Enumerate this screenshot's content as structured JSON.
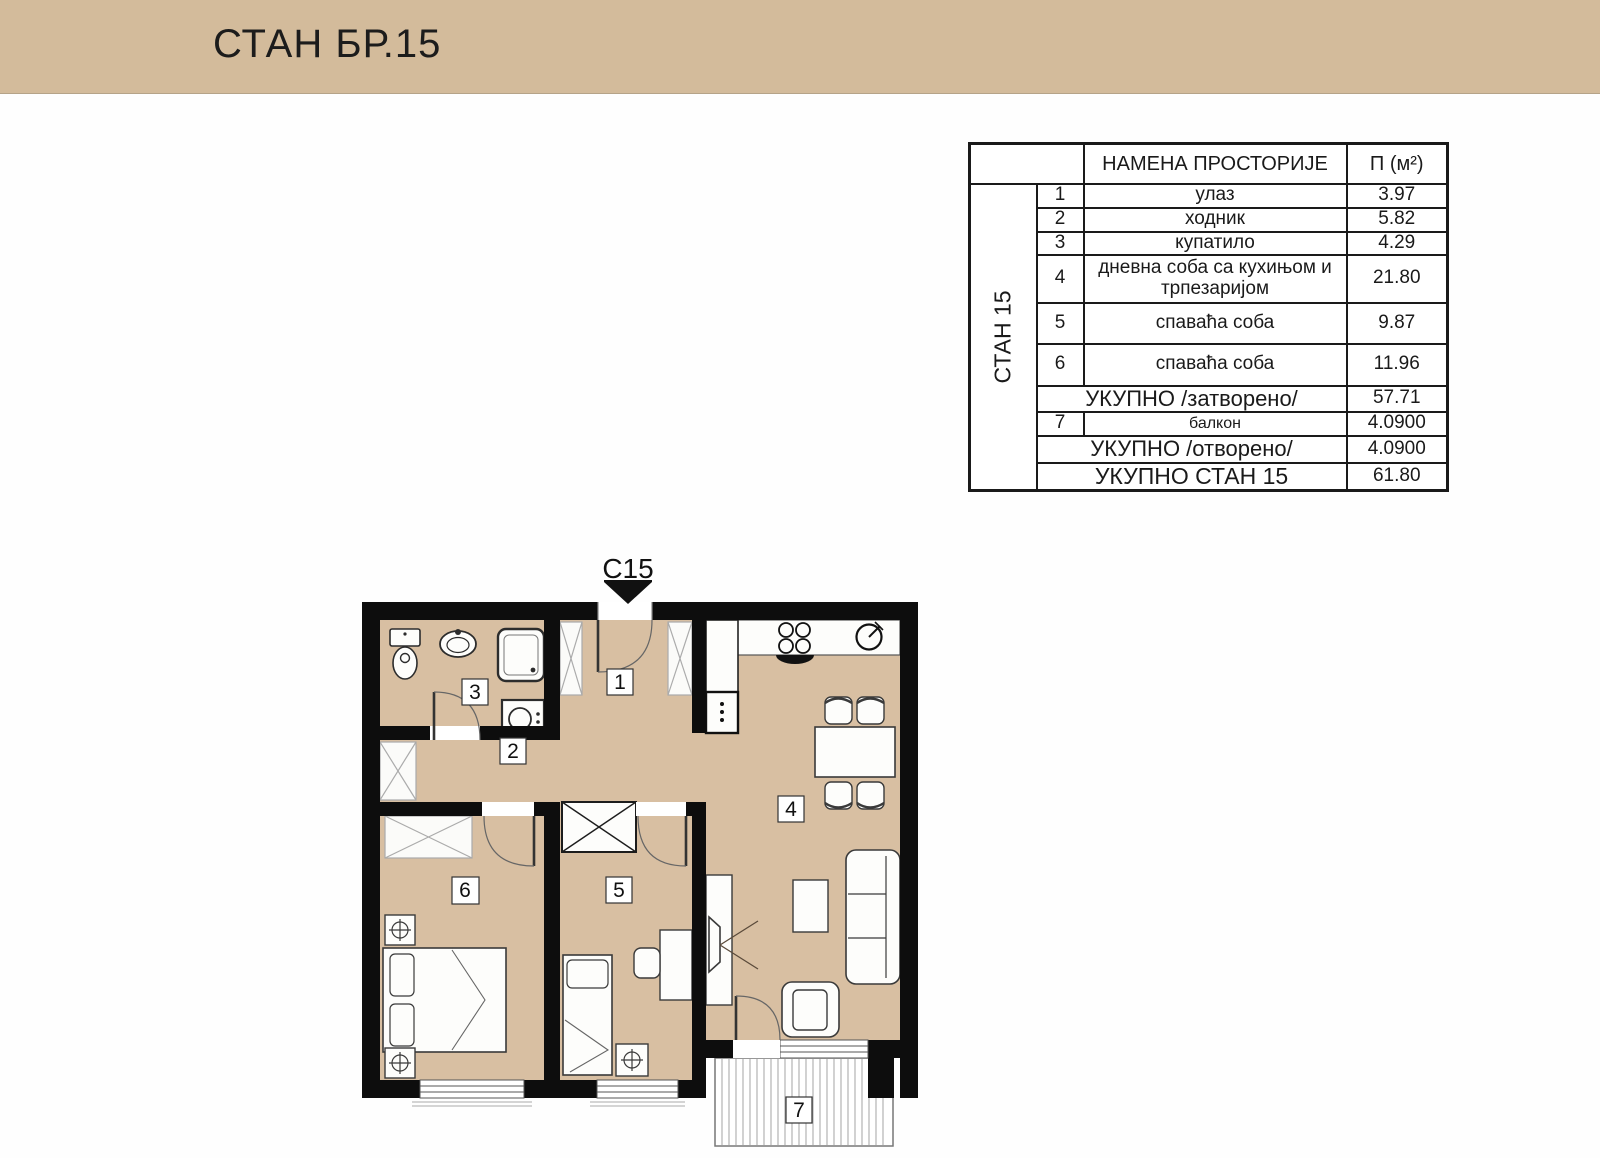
{
  "header": {
    "title": "СТАН БР.15",
    "bg_color": "#d3bb9b"
  },
  "table": {
    "group_label": "СТАН 15",
    "headers": {
      "name": "НАМЕНА ПРОСТОРИЈЕ",
      "area": "П (м²)"
    },
    "rows": [
      {
        "num": "1",
        "name": "улаз",
        "area": "3.97"
      },
      {
        "num": "2",
        "name": "ходник",
        "area": "5.82"
      },
      {
        "num": "3",
        "name": "купатило",
        "area": "4.29"
      },
      {
        "num": "4",
        "name": "дневна соба са кухињом и трпезаријом",
        "area": "21.80"
      },
      {
        "num": "5",
        "name": "спаваћа соба",
        "area": "9.87"
      },
      {
        "num": "6",
        "name": "спаваћа соба",
        "area": "11.96"
      }
    ],
    "subtotal_closed": {
      "label": "УКУПНО /затворено/",
      "area": "57.71"
    },
    "balcony": {
      "num": "7",
      "name": "балкон",
      "area": "4.0900"
    },
    "subtotal_open": {
      "label": "УКУПНО /отворено/",
      "area": "4.0900"
    },
    "total": {
      "label": "УКУПНО СТАН 15",
      "area": "61.80"
    }
  },
  "plan": {
    "entrance_marker": "C15",
    "labels": {
      "l1": "1",
      "l2": "2",
      "l3": "3",
      "l4": "4",
      "l5": "5",
      "l6": "6",
      "l7": "7"
    },
    "colors": {
      "floor": "#d8bfa2",
      "wall": "#0d0d0d",
      "furniture": "#fdfdfb"
    }
  }
}
